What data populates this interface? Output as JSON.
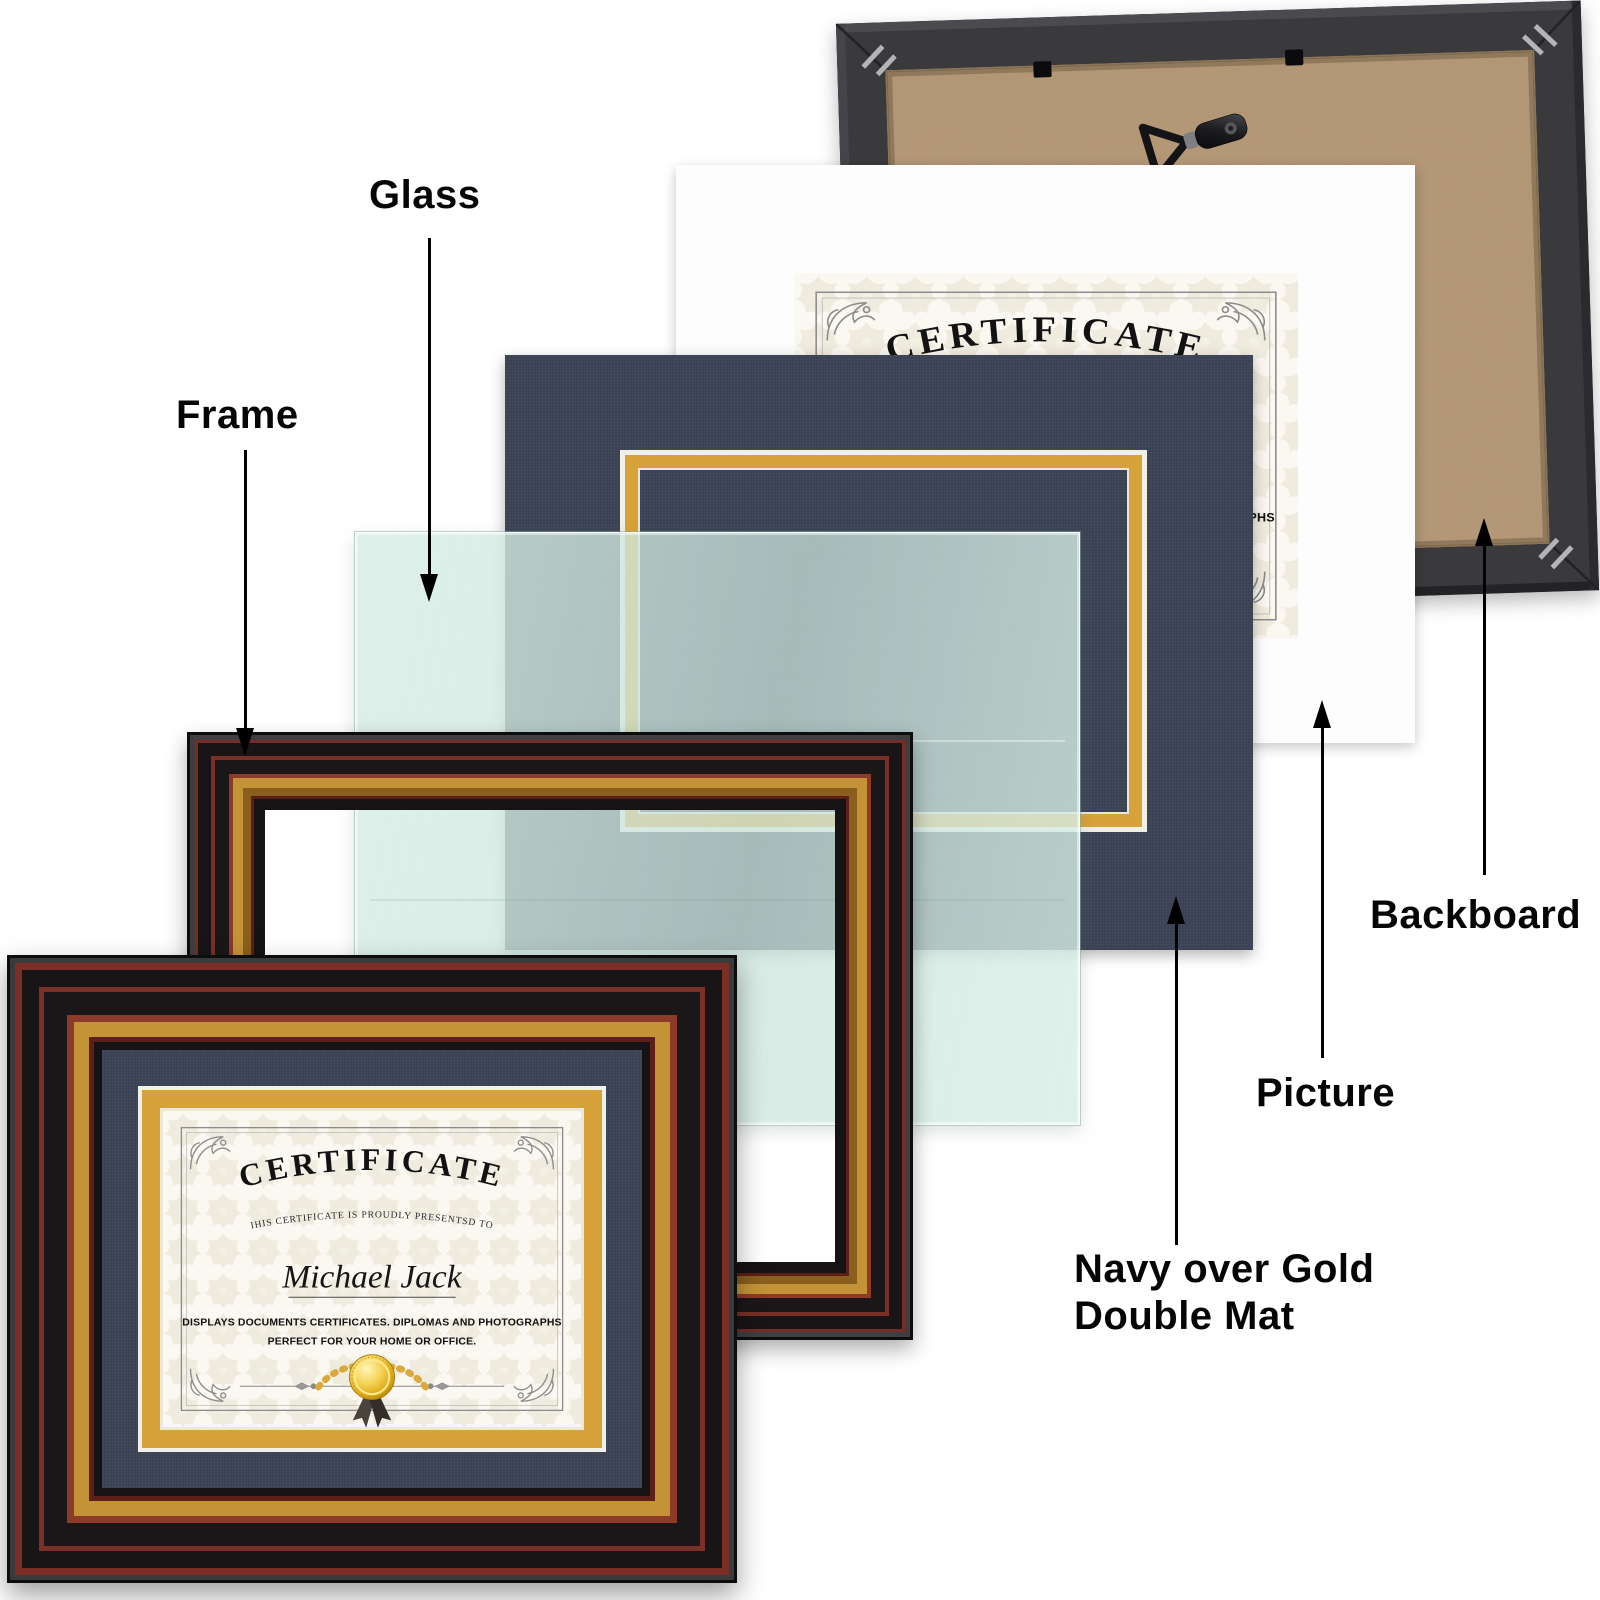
{
  "diagram": {
    "description": "Exploded view of certificate picture frame components"
  },
  "labels": {
    "glass": "Glass",
    "frame": "Frame",
    "backboard": "Backboard",
    "picture": "Picture",
    "double_mat_line1": "Navy over Gold",
    "double_mat_line2": "Double Mat"
  },
  "certificate": {
    "title": "CERTIFICATE",
    "subtitle": "IHIS CERTIFICATE IS PROUDLY PRESENTSD TO",
    "recipient_name": "Michael Jack",
    "body_line1": "DISPLAYS DOCUMENTS CERTIFICATES. DIPLOMAS AND PHOTOGRAPHS",
    "body_line2": "PERFECT FOR YOUR HOME OR OFFICE."
  },
  "colors": {
    "navy_mat": "#3a4153",
    "gold_mat": "#d7a23a",
    "frame_gold": "#c49338",
    "frame_maroon": "#7a2e26",
    "frame_black": "#191516",
    "kraft_board": "#b49877",
    "backboard_frame": "#3a393c",
    "glass_tint": "#d6ede5",
    "label_text": "#060606"
  }
}
